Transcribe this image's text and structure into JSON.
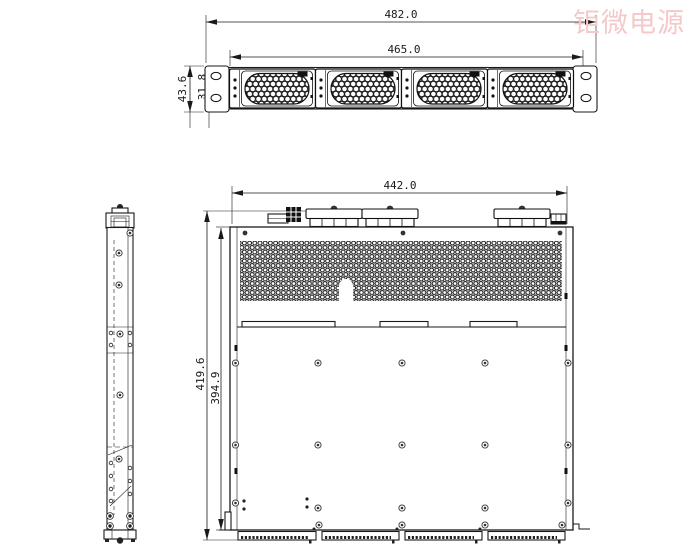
{
  "watermark": {
    "text": "钜微电源",
    "color": "#f5c9c9"
  },
  "front_view": {
    "dim_width_outer": "482.0",
    "dim_width_inner": "465.0",
    "dim_height": "43.6",
    "dim_hole_spacing": "31.8",
    "fan_modules": 4
  },
  "top_view": {
    "dim_width": "442.0",
    "dim_depth_outer": "419.6",
    "dim_depth_inner": "394.9"
  },
  "colors": {
    "line": "#1a1a1a",
    "background": "#ffffff"
  }
}
